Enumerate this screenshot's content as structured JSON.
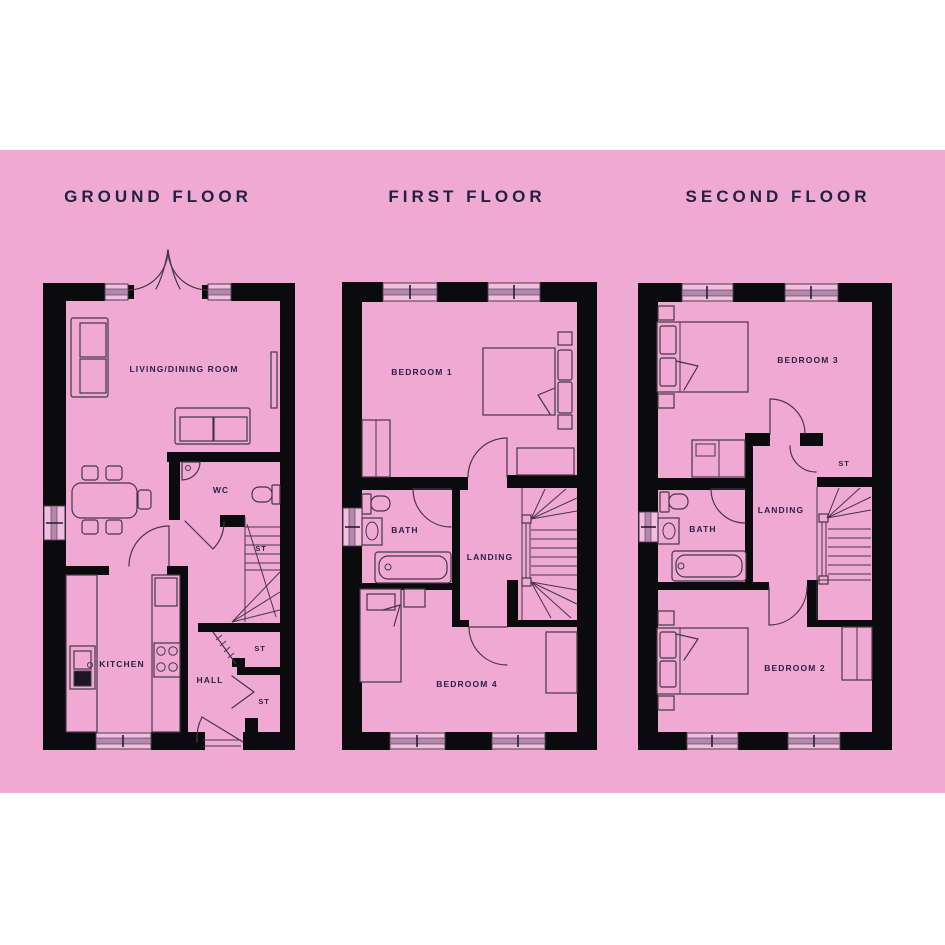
{
  "page": {
    "background": "#ffffff",
    "panel_color": "#efa9d2",
    "wall_color": "#0b0b0e",
    "line_color": "#453648",
    "title_color": "#22223e",
    "label_color": "#2b2340"
  },
  "floors": [
    {
      "title": "GROUND FLOOR",
      "labels": {
        "living": "LIVING/DINING ROOM",
        "wc": "WC",
        "stairs_st": "ST",
        "kitchen": "KITCHEN",
        "hall": "HALL",
        "cupboard1": "ST",
        "cupboard2": "ST"
      }
    },
    {
      "title": "FIRST FLOOR",
      "labels": {
        "bedroom1": "BEDROOM 1",
        "bath": "BATH",
        "landing": "LANDING",
        "bedroom4": "BEDROOM 4"
      }
    },
    {
      "title": "SECOND FLOOR",
      "labels": {
        "bedroom3": "BEDROOM 3",
        "st": "ST",
        "bath": "BATH",
        "landing": "LANDING",
        "bedroom2": "BEDROOM 2"
      }
    }
  ]
}
